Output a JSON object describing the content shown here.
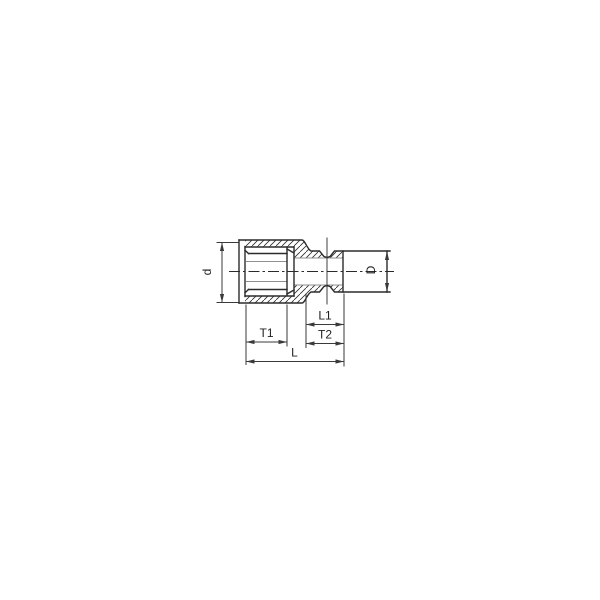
{
  "diagram": {
    "type": "technical-drawing",
    "background_color": "#ffffff",
    "line_color": "#2b2b2b",
    "dim_color": "#3a3a3a",
    "thin_line_color": "#8f8f8f",
    "text_color": "#1f1f1f",
    "labels": {
      "d": "d",
      "D": "D",
      "T1": "T1",
      "L1": "L1",
      "T2": "T2",
      "L": "L"
    }
  }
}
